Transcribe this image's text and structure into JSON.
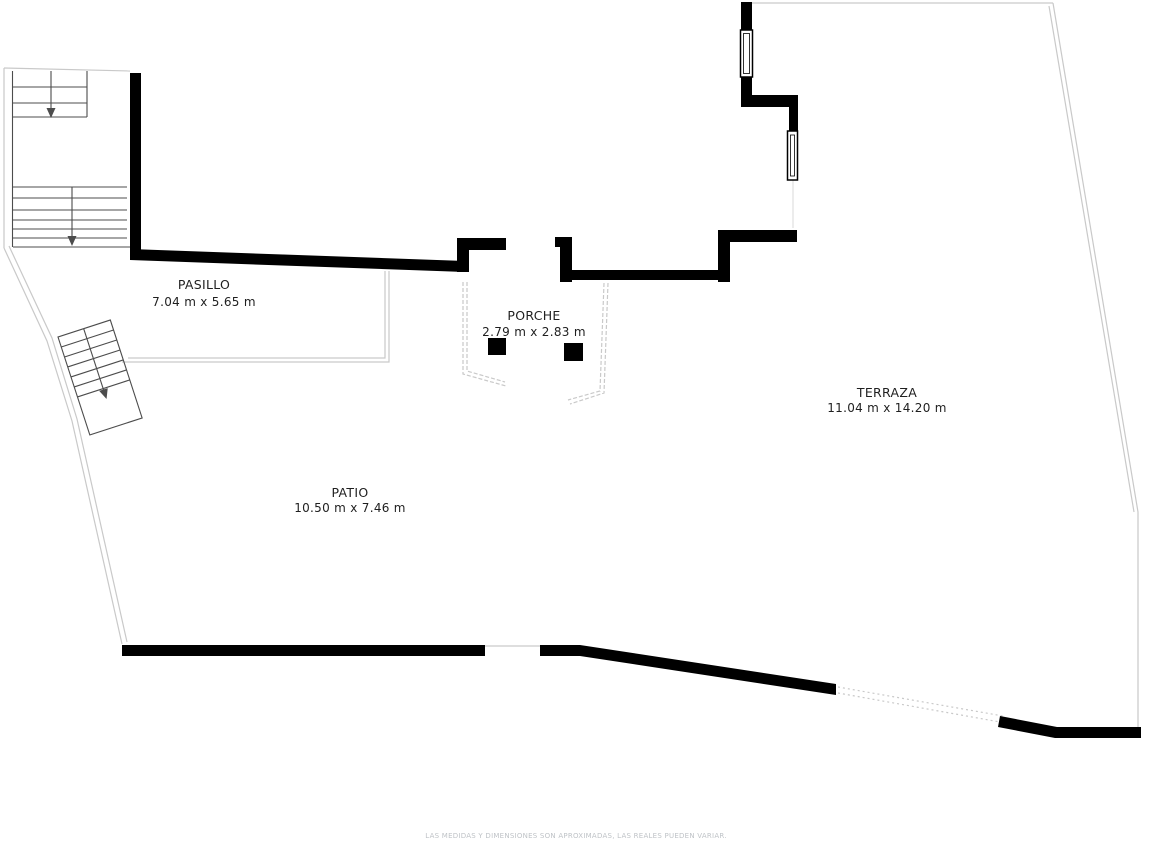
{
  "page": {
    "background": "#ffffff"
  },
  "colors": {
    "wall": "#000000",
    "boundary_line": "#c9c9c9",
    "faint_line": "#e0e0e0",
    "stair_line": "#4c4c4c",
    "label_text": "#1f1f1f",
    "disclaimer_text": "#bfc3c7",
    "window_fill": "#ffffff"
  },
  "rooms": [
    {
      "id": "pasillo",
      "name": "PASILLO",
      "dimensions": "7.04 m x 5.65 m"
    },
    {
      "id": "porche",
      "name": "PORCHE",
      "dimensions": "2.79 m x 2.83 m"
    },
    {
      "id": "terraza",
      "name": "TERRAZA",
      "dimensions": "11.04 m x 14.20 m"
    },
    {
      "id": "patio",
      "name": "PATIO",
      "dimensions": "10.50 m x 7.46 m"
    }
  ],
  "disclaimer": "LAS MEDIDAS Y DIMENSIONES SON APROXIMADAS, LAS REALES PUEDEN VARIAR."
}
